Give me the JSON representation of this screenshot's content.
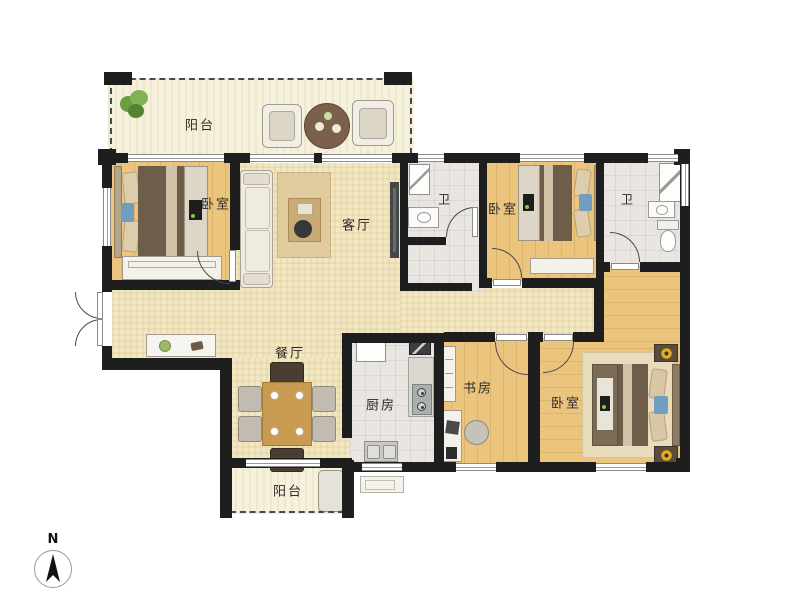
{
  "plan_title": "4-room residential floor plan",
  "rooms": [
    {
      "id": "balcony-top",
      "label": "阳台"
    },
    {
      "id": "bedroom-1",
      "label": "卧室"
    },
    {
      "id": "living-room",
      "label": "客厅"
    },
    {
      "id": "bathroom-1",
      "label": "卫"
    },
    {
      "id": "bedroom-2",
      "label": "卧室"
    },
    {
      "id": "bathroom-2",
      "label": "卫"
    },
    {
      "id": "dining-room",
      "label": "餐厅"
    },
    {
      "id": "kitchen",
      "label": "厨房"
    },
    {
      "id": "study",
      "label": "书房"
    },
    {
      "id": "bedroom-3",
      "label": "卧室"
    },
    {
      "id": "balcony-bottom",
      "label": "阳台"
    }
  ],
  "compass": {
    "north_label": "N"
  },
  "colors": {
    "wall": "#1e1e1e",
    "floor_living_dining": "#f2e7c3",
    "floor_wood": "#ebc57e",
    "floor_tile": "#e9e6e1",
    "floor_balcony": "#f6f1dd",
    "bed_duvet": "#6e5d49",
    "accent_blue": "#6f9ec0",
    "accent_gold": "#e2ae25",
    "plant_green": "#6a9e3f",
    "rug": "#dfcb9e"
  }
}
